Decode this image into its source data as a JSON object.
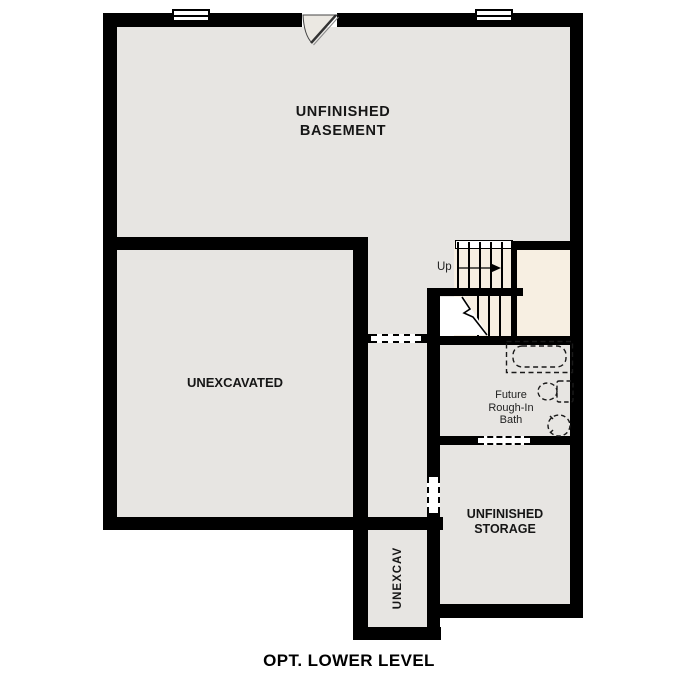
{
  "title": "OPT. LOWER LEVEL",
  "colors": {
    "wall": "#000000",
    "floor_fill": "#e7e5e2",
    "stair_fill": "#f7efe2",
    "background": "#ffffff"
  },
  "rooms": {
    "basement": {
      "label": "UNFINISHED\nBASEMENT"
    },
    "unexcavated": {
      "label": "UNEXCAVATED"
    },
    "bath": {
      "label": "Future\nRough-In\nBath"
    },
    "storage": {
      "label": "UNFINISHED\nSTORAGE"
    },
    "unexcav": {
      "label": "UNEXCAV"
    }
  },
  "stairs": {
    "direction_label": "Up"
  },
  "fixtures": [
    "bathtub",
    "toilet",
    "sink"
  ],
  "openings": [
    "corridor-opening",
    "bath-opening",
    "storage-opening"
  ],
  "windows_count": 2,
  "doors_count": 1
}
